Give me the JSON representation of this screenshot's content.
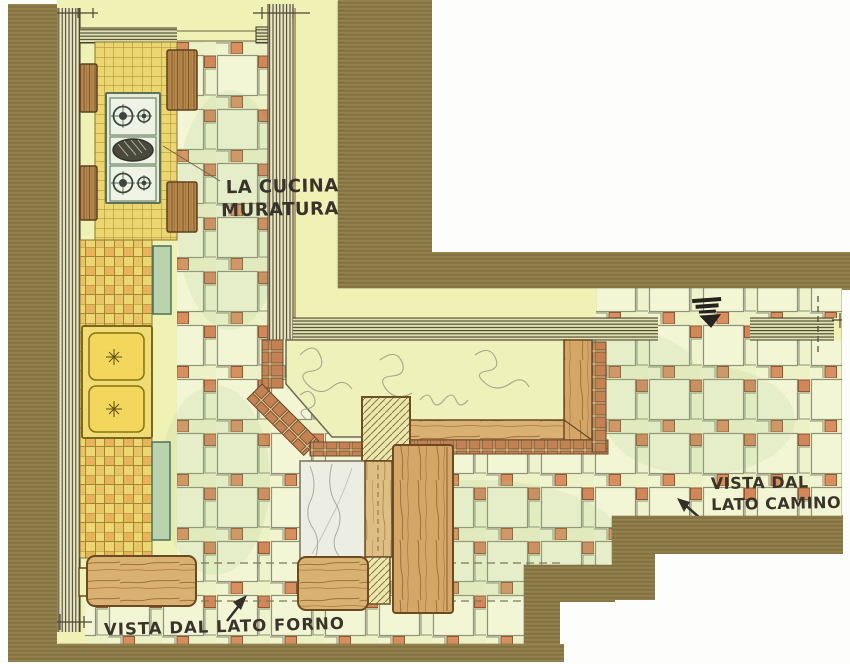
{
  "labels": {
    "title_line1": "LA CUCINA IN",
    "title_line2": "MURATURA",
    "camino_line1": "VISTA DAL",
    "camino_line2": "LATO CAMINO",
    "forno": "VISTA DAL LATO FORNO"
  },
  "icons": {
    "flue_marker": "flue-marker-icon",
    "camino_arrow": "arrow-up-left-icon",
    "forno_arrow": "arrow-up-right-icon",
    "dimension_ticks": "dimension-tick-icon"
  },
  "colors": {
    "background": "#fdfdfb",
    "cardboard": "#8c7a47",
    "paper": "#eff1b5",
    "floor_tile": "#f3f6d4",
    "floor_accent": "#d2875a",
    "counter_tile": "#ecd671",
    "counter_accent": "#e7b45c",
    "wood": "#d4a768",
    "brick": "#c28254",
    "green_trim": "#b9d3ae",
    "marble": "#edeee3",
    "ink": "#39332b"
  }
}
